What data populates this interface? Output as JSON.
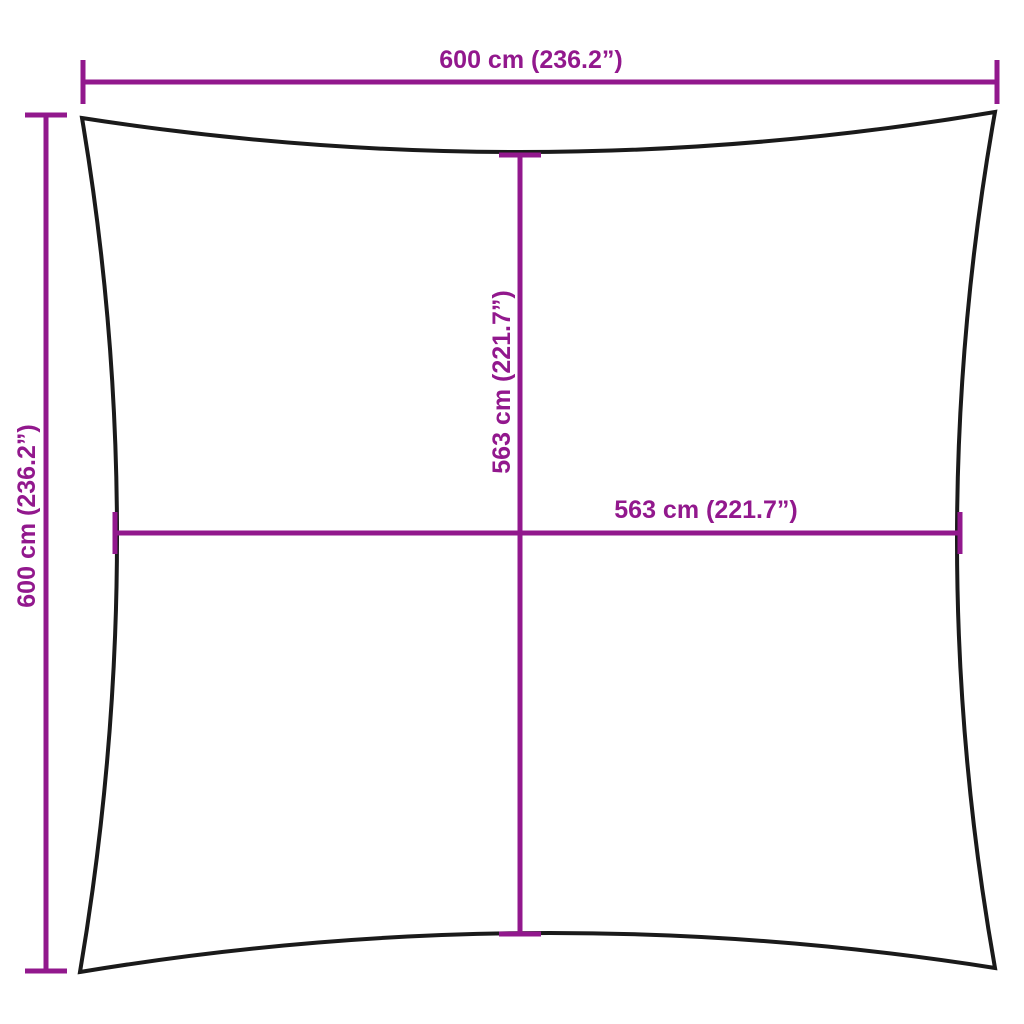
{
  "diagram": {
    "colors": {
      "dimension": "#92188D",
      "outline": "#1a1a1a",
      "background": "#ffffff"
    },
    "dimensions": {
      "top": {
        "label": "600 cm (236.2”)",
        "cm": 600,
        "inches": 236.2
      },
      "left": {
        "label": "600 cm (236.2”)",
        "cm": 600,
        "inches": 236.2
      },
      "inner_vertical": {
        "label": "563 cm (221.7”)",
        "cm": 563,
        "inches": 221.7
      },
      "inner_horizontal": {
        "label": "563 cm (221.7”)",
        "cm": 563,
        "inches": 221.7
      }
    }
  }
}
